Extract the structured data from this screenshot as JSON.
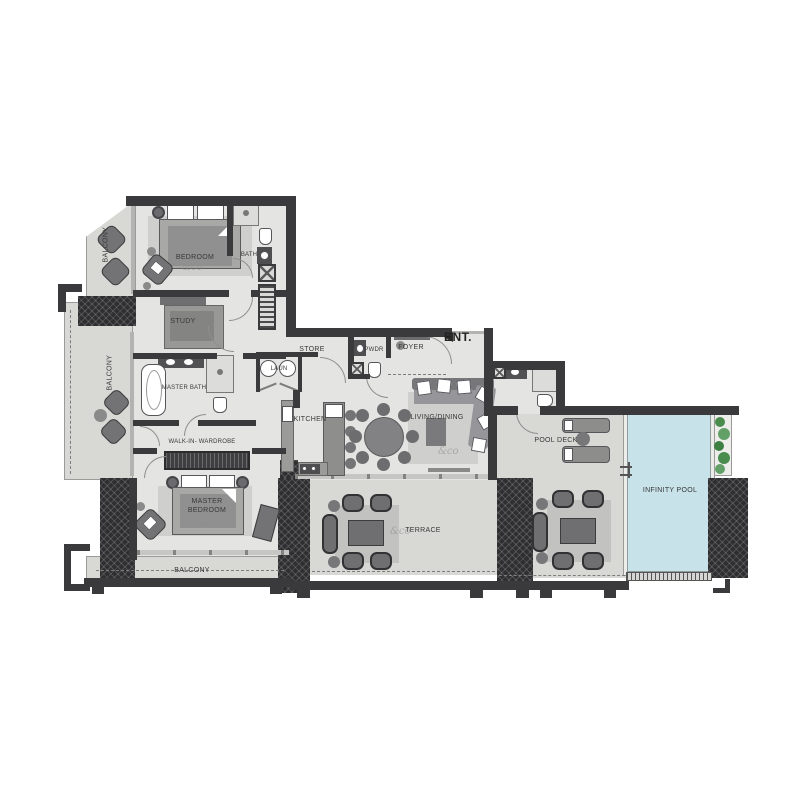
{
  "labels": {
    "balcony_top": "BALCONY",
    "bedroom": "BEDROOM",
    "bath": "BATH",
    "study": "STUDY",
    "balcony_left": "BALCONY",
    "master_bath": "MASTER BATH",
    "walk_in_wardrobe": "WALK-IN- WARDROBE",
    "master_bedroom": "MASTER\nBEDROOM",
    "balcony_bottom": "BALCONY",
    "store": "STORE",
    "laundry": "LAUN",
    "powder": "PWDR",
    "foyer": "FOYER",
    "entrance": "ENT.",
    "kitchen": "KITCHEN",
    "living_dining": "LIVING/DINING",
    "pool_deck": "POOL DECK",
    "infinity_pool": "INFINITY POOL",
    "terrace": "TERRACE",
    "watermark": "&co"
  },
  "colors": {
    "wall": "#3a3a3c",
    "interior_floor": "#e4e4e2",
    "outdoor_floor": "#d8d8d5",
    "pool_water": "#c8e2e9",
    "planting": "#4a8c4e",
    "structure_hatch": "#2f2f31",
    "furniture": "#8f8f8d",
    "label_text": "#383838"
  }
}
